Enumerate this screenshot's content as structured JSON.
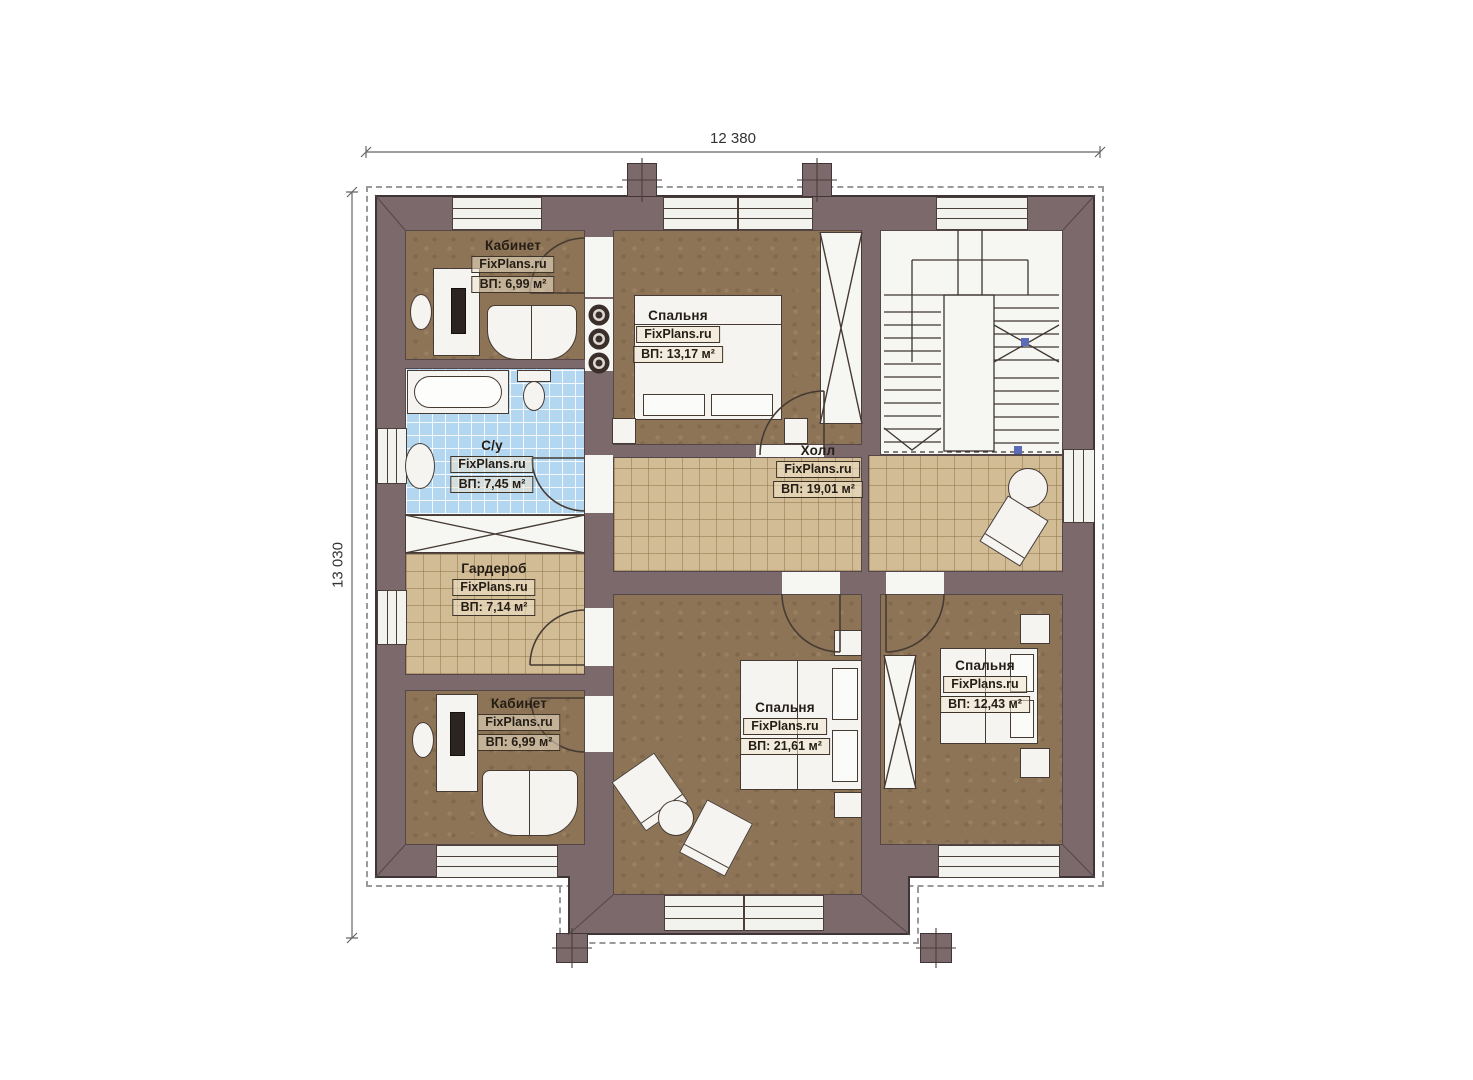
{
  "plan": {
    "watermark": "FixPlans.ru",
    "dimensions": {
      "width_label": "12 380",
      "height_label": "13 030"
    },
    "rooms": [
      {
        "name": "Кабинет",
        "area_label": "ВП: 6,99 м²"
      },
      {
        "name": "Спальня",
        "area_label": "ВП: 13,17 м²"
      },
      {
        "name": "С/у",
        "area_label": "ВП: 7,45 м²"
      },
      {
        "name": "Холл",
        "area_label": "ВП: 19,01 м²"
      },
      {
        "name": "Гардероб",
        "area_label": "ВП: 7,14 м²"
      },
      {
        "name": "Кабинет",
        "area_label": "ВП: 6,99 м²"
      },
      {
        "name": "Спальня",
        "area_label": "ВП: 21,61 м²"
      },
      {
        "name": "Спальня",
        "area_label": "ВП: 12,43 м²"
      }
    ],
    "colors": {
      "wall": "#7c696b",
      "room_floor": "#8d7456",
      "hall_tile": "#d2bc96",
      "bath_tile": "#b3d6f1"
    }
  }
}
